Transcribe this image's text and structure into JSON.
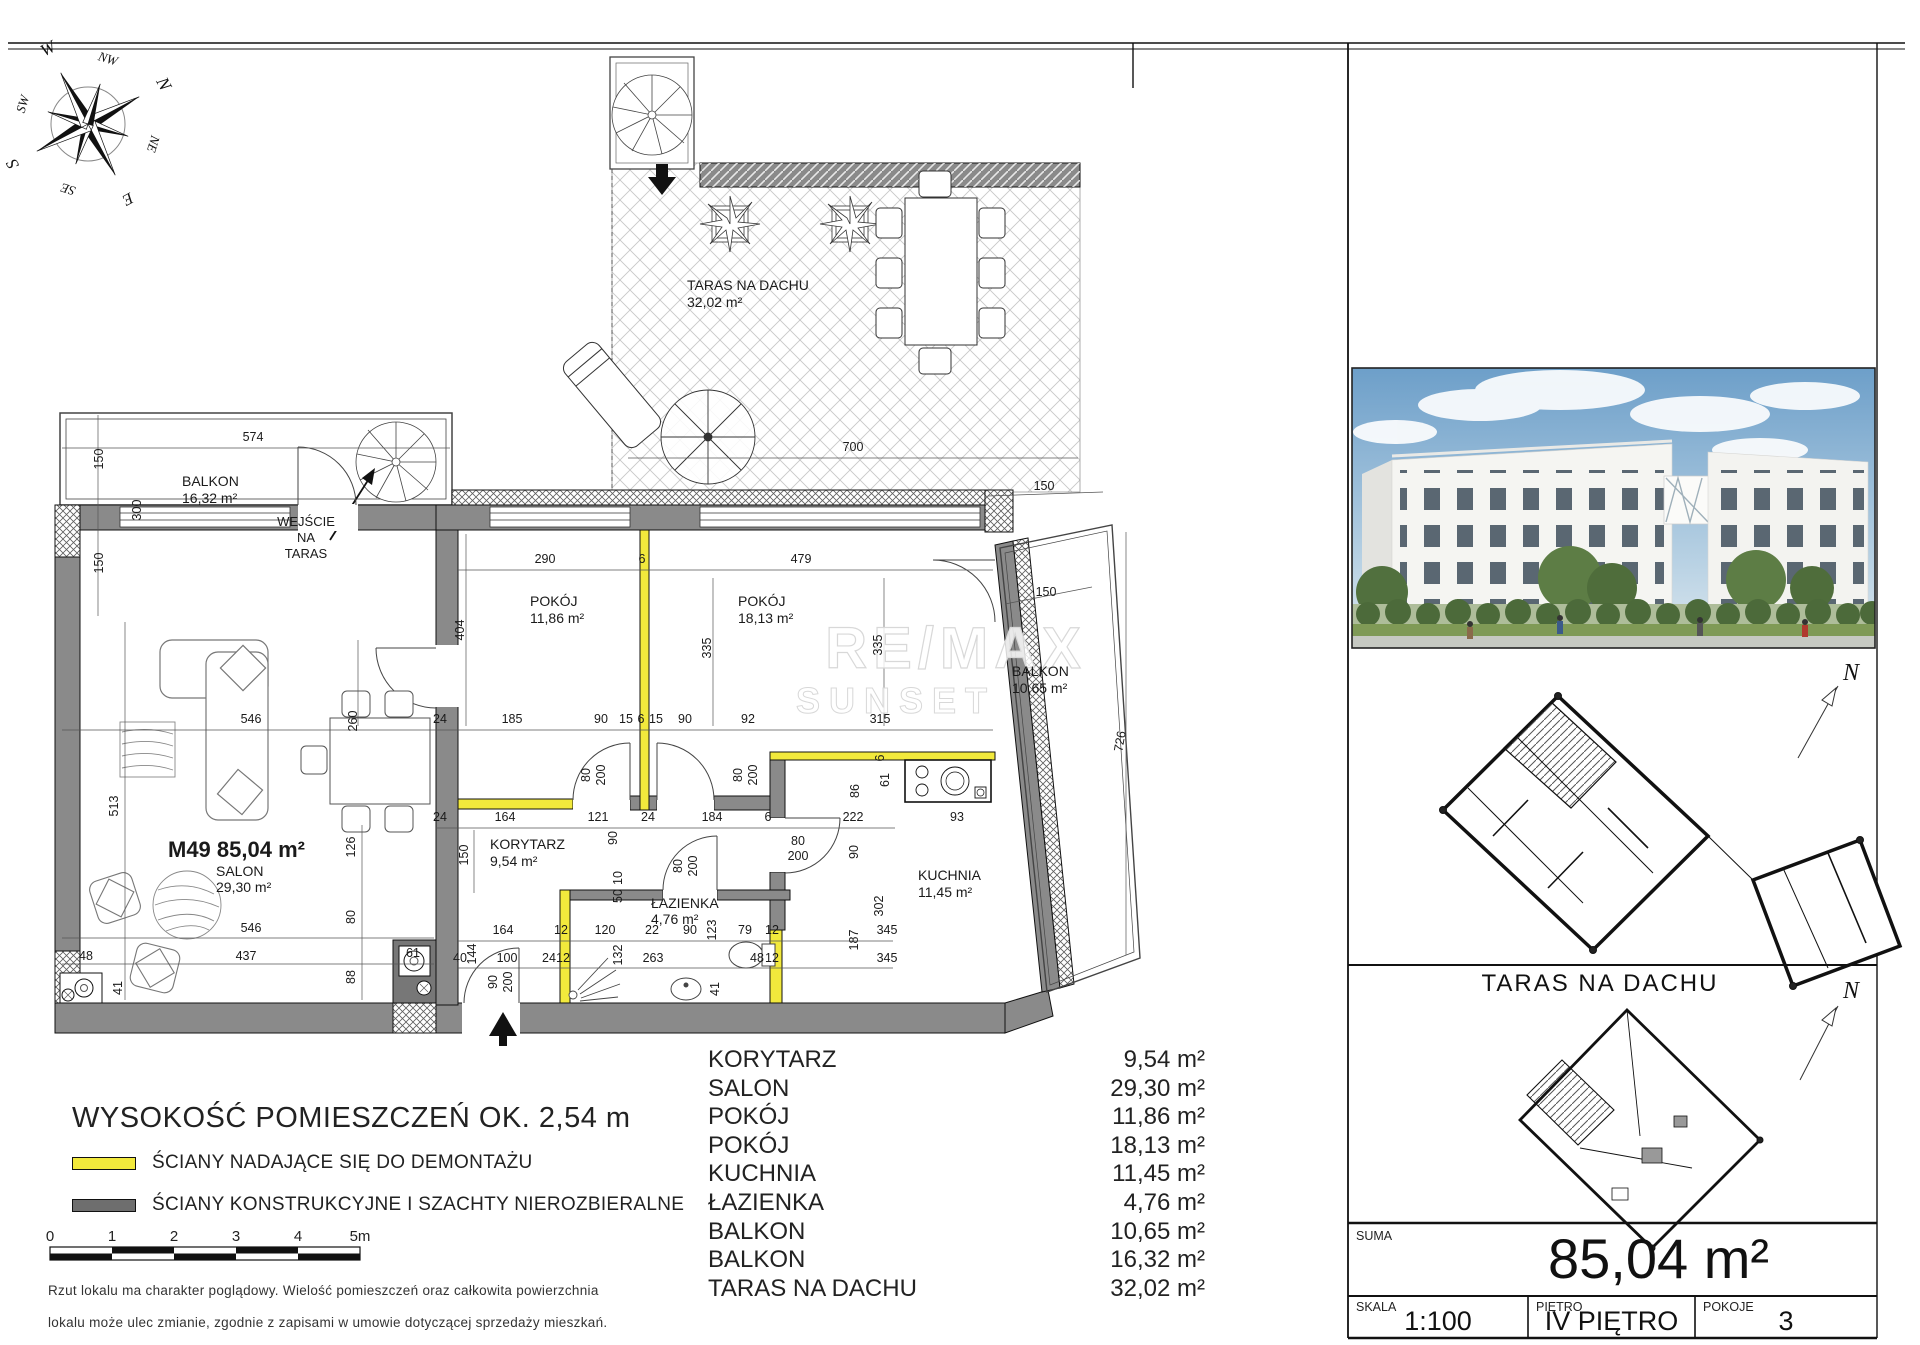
{
  "compass": {
    "points": [
      {
        "label": "N",
        "angle": 62,
        "r": 80,
        "size": 18
      },
      {
        "label": "NE",
        "angle": 107,
        "r": 64,
        "size": 13
      },
      {
        "label": "E",
        "angle": 152,
        "r": 80,
        "size": 16
      },
      {
        "label": "SE",
        "angle": 197,
        "r": 64,
        "size": 13
      },
      {
        "label": "S",
        "angle": 242,
        "r": 80,
        "size": 17
      },
      {
        "label": "SW",
        "angle": 287,
        "r": 64,
        "size": 13
      },
      {
        "label": "W",
        "angle": 332,
        "r": 80,
        "size": 17
      },
      {
        "label": "NW",
        "angle": 17,
        "r": 64,
        "size": 13
      }
    ]
  },
  "watermark": {
    "line1": "RE/MAX",
    "line2": "SUNSET"
  },
  "plan": {
    "rooms": [
      {
        "lines": [
          "TARAS NA DACHU",
          "32,02 m²"
        ],
        "x": 687,
        "y": 290,
        "size": 14,
        "lh": 17
      },
      {
        "lines": [
          "BALKON",
          "16,32 m²"
        ],
        "x": 182,
        "y": 486,
        "size": 14,
        "lh": 17
      },
      {
        "lines": [
          "WEJŚCIE",
          "NA",
          "TARAS"
        ],
        "x": 306,
        "y": 526,
        "size": 13,
        "lh": 16,
        "anchor": "middle"
      },
      {
        "lines": [
          "POKÓJ",
          "11,86 m²"
        ],
        "x": 530,
        "y": 606,
        "size": 14,
        "lh": 17
      },
      {
        "lines": [
          "POKÓJ",
          "18,13 m²"
        ],
        "x": 738,
        "y": 606,
        "size": 14,
        "lh": 17
      },
      {
        "lines": [
          "KORYTARZ",
          "9,54 m²"
        ],
        "x": 490,
        "y": 849,
        "size": 14,
        "lh": 17
      },
      {
        "lines": [
          "ŁAZIENKA",
          "4,76 m²"
        ],
        "x": 651,
        "y": 908,
        "size": 14,
        "lh": 16
      },
      {
        "lines": [
          "KUCHNIA",
          "11,45 m²"
        ],
        "x": 918,
        "y": 880,
        "size": 14,
        "lh": 17
      },
      {
        "lines": [
          "M49 85,04 m²"
        ],
        "x": 168,
        "y": 857,
        "size": 22,
        "bold": true
      },
      {
        "lines": [
          "SALON",
          "29,30 m²"
        ],
        "x": 216,
        "y": 876,
        "size": 14,
        "lh": 16
      },
      {
        "lines": [
          "BALKON",
          "10,65 m²"
        ],
        "x": 1012,
        "y": 676,
        "size": 14,
        "lh": 17
      }
    ],
    "dims": [
      {
        "t": "700",
        "x": 853,
        "y": 451
      },
      {
        "t": "574",
        "x": 253,
        "y": 441
      },
      {
        "t": "150",
        "x": 103,
        "y": 459,
        "r": -90
      },
      {
        "t": "300",
        "x": 141,
        "y": 510,
        "r": -90
      },
      {
        "t": "150",
        "x": 103,
        "y": 563,
        "r": -90
      },
      {
        "t": "290",
        "x": 545,
        "y": 563
      },
      {
        "t": "6",
        "x": 642,
        "y": 563
      },
      {
        "t": "479",
        "x": 801,
        "y": 563
      },
      {
        "t": "404",
        "x": 464,
        "y": 630,
        "r": -90
      },
      {
        "t": "150",
        "x": 1044,
        "y": 490
      },
      {
        "t": "335",
        "x": 711,
        "y": 648,
        "r": -90
      },
      {
        "t": "335",
        "x": 882,
        "y": 645,
        "r": -90
      },
      {
        "t": "726",
        "x": 1124,
        "y": 742,
        "r": -80
      },
      {
        "t": "546",
        "x": 251,
        "y": 723
      },
      {
        "t": "260",
        "x": 357,
        "y": 721,
        "r": -90
      },
      {
        "t": "24",
        "x": 440,
        "y": 723
      },
      {
        "t": "185",
        "x": 512,
        "y": 723
      },
      {
        "t": "90",
        "x": 601,
        "y": 723
      },
      {
        "t": "15",
        "x": 626,
        "y": 723
      },
      {
        "t": "6",
        "x": 641,
        "y": 723
      },
      {
        "t": "15",
        "x": 656,
        "y": 723
      },
      {
        "t": "90",
        "x": 685,
        "y": 723
      },
      {
        "t": "92",
        "x": 748,
        "y": 723
      },
      {
        "t": "315",
        "x": 880,
        "y": 723
      },
      {
        "t": "24",
        "x": 440,
        "y": 821
      },
      {
        "t": "164",
        "x": 505,
        "y": 821
      },
      {
        "t": "121",
        "x": 598,
        "y": 821
      },
      {
        "t": "24",
        "x": 648,
        "y": 821
      },
      {
        "t": "184",
        "x": 712,
        "y": 821
      },
      {
        "t": "6",
        "x": 768,
        "y": 821
      },
      {
        "t": "222",
        "x": 853,
        "y": 821
      },
      {
        "t": "93",
        "x": 957,
        "y": 821
      },
      {
        "t": "80",
        "x": 590,
        "y": 775,
        "r": -90
      },
      {
        "t": "200",
        "x": 605,
        "y": 775,
        "r": -90
      },
      {
        "t": "80",
        "x": 742,
        "y": 775,
        "r": -90
      },
      {
        "t": "200",
        "x": 757,
        "y": 775,
        "r": -90
      },
      {
        "t": "80",
        "x": 682,
        "y": 866,
        "r": -90
      },
      {
        "t": "200",
        "x": 697,
        "y": 866,
        "r": -90
      },
      {
        "t": "80",
        "x": 798,
        "y": 845
      },
      {
        "t": "200",
        "x": 798,
        "y": 860
      },
      {
        "t": "90",
        "x": 497,
        "y": 982,
        "r": -90
      },
      {
        "t": "200",
        "x": 512,
        "y": 982,
        "r": -90
      },
      {
        "t": "513",
        "x": 118,
        "y": 806,
        "r": -90
      },
      {
        "t": "126",
        "x": 355,
        "y": 847,
        "r": -90
      },
      {
        "t": "80",
        "x": 355,
        "y": 917,
        "r": -90
      },
      {
        "t": "88",
        "x": 355,
        "y": 977,
        "r": -90
      },
      {
        "t": "150",
        "x": 468,
        "y": 855,
        "r": -90
      },
      {
        "t": "90",
        "x": 617,
        "y": 838,
        "r": -90
      },
      {
        "t": "10",
        "x": 622,
        "y": 878,
        "r": -90
      },
      {
        "t": "50",
        "x": 622,
        "y": 896,
        "r": -90
      },
      {
        "t": "164",
        "x": 503,
        "y": 934
      },
      {
        "t": "12",
        "x": 561,
        "y": 934
      },
      {
        "t": "120",
        "x": 605,
        "y": 934
      },
      {
        "t": "22",
        "x": 652,
        "y": 934
      },
      {
        "t": "90",
        "x": 690,
        "y": 934
      },
      {
        "t": "123",
        "x": 716,
        "y": 930,
        "r": -90
      },
      {
        "t": "79",
        "x": 745,
        "y": 934
      },
      {
        "t": "12",
        "x": 772,
        "y": 934
      },
      {
        "t": "187",
        "x": 858,
        "y": 940,
        "r": -90
      },
      {
        "t": "345",
        "x": 887,
        "y": 934
      },
      {
        "t": "302",
        "x": 883,
        "y": 906,
        "r": -90
      },
      {
        "t": "345",
        "x": 887,
        "y": 962
      },
      {
        "t": "40",
        "x": 460,
        "y": 962
      },
      {
        "t": "144",
        "x": 476,
        "y": 954,
        "r": -90
      },
      {
        "t": "100",
        "x": 507,
        "y": 962
      },
      {
        "t": "24",
        "x": 549,
        "y": 962
      },
      {
        "t": "12",
        "x": 563,
        "y": 962
      },
      {
        "t": "132",
        "x": 622,
        "y": 955,
        "r": -90
      },
      {
        "t": "263",
        "x": 653,
        "y": 962
      },
      {
        "t": "48",
        "x": 757,
        "y": 962
      },
      {
        "t": "12",
        "x": 772,
        "y": 962
      },
      {
        "t": "41",
        "x": 719,
        "y": 989,
        "r": -90
      },
      {
        "t": "546",
        "x": 251,
        "y": 932
      },
      {
        "t": "437",
        "x": 246,
        "y": 960
      },
      {
        "t": "48",
        "x": 86,
        "y": 960
      },
      {
        "t": "41",
        "x": 122,
        "y": 988,
        "r": -90
      },
      {
        "t": "61",
        "x": 413,
        "y": 957
      },
      {
        "t": "6",
        "x": 884,
        "y": 758,
        "r": -90
      },
      {
        "t": "86",
        "x": 859,
        "y": 791,
        "r": -90
      },
      {
        "t": "61",
        "x": 889,
        "y": 780,
        "r": -90
      },
      {
        "t": "150",
        "x": 1046,
        "y": 596
      },
      {
        "t": "90",
        "x": 858,
        "y": 852,
        "r": -90
      }
    ]
  },
  "legend": {
    "height_note": "WYSOKOŚĆ POMIESZCZEŃ OK. 2,54 m",
    "items": [
      {
        "label": "ŚCIANY NADAJĄCE SIĘ DO DEMONTAŻU",
        "color": "#f2e93c"
      },
      {
        "label": "ŚCIANY KONSTRUKCYJNE I SZACHTY NIEROZBIERALNE",
        "color": "#6e6e6e"
      }
    ],
    "scalebar": {
      "ticks": [
        "0",
        "1",
        "2",
        "3",
        "4",
        "5m"
      ]
    }
  },
  "room_table": {
    "rows": [
      {
        "name": "KORYTARZ",
        "area": "9,54 m²"
      },
      {
        "name": "SALON",
        "area": "29,30 m²"
      },
      {
        "name": "POKÓJ",
        "area": "11,86 m²"
      },
      {
        "name": "POKÓJ",
        "area": "18,13 m²"
      },
      {
        "name": "KUCHNIA",
        "area": "11,45 m²"
      },
      {
        "name": "ŁAZIENKA",
        "area": "4,76 m²"
      },
      {
        "name": "BALKON",
        "area": "10,65 m²"
      },
      {
        "name": "BALKON",
        "area": "16,32 m²"
      },
      {
        "name": "TARAS NA DACHU",
        "area": "32,02 m²"
      }
    ]
  },
  "disclaimer": [
    "Rzut lokalu ma charakter poglądowy. Wielość pomieszczeń oraz całkowita powierzchnia",
    "lokalu może ulec zmianie, zgodnie z zapisami w umowie dotyczącej sprzedaży mieszkań."
  ],
  "side_panel": {
    "north_label": "N",
    "taras_heading": "TARAS NA DACHU",
    "suma": {
      "label": "SUMA",
      "value": "85,04 m²"
    },
    "skala": {
      "label": "SKALA",
      "value": "1:100"
    },
    "pietro": {
      "label": "PIĘTRO",
      "value": "IV PIĘTRO"
    },
    "pokoje": {
      "label": "POKOJE",
      "value": "3"
    }
  },
  "colors": {
    "demountable_wall": "#f2e93c",
    "structural_wall": "#8a8a8a"
  }
}
